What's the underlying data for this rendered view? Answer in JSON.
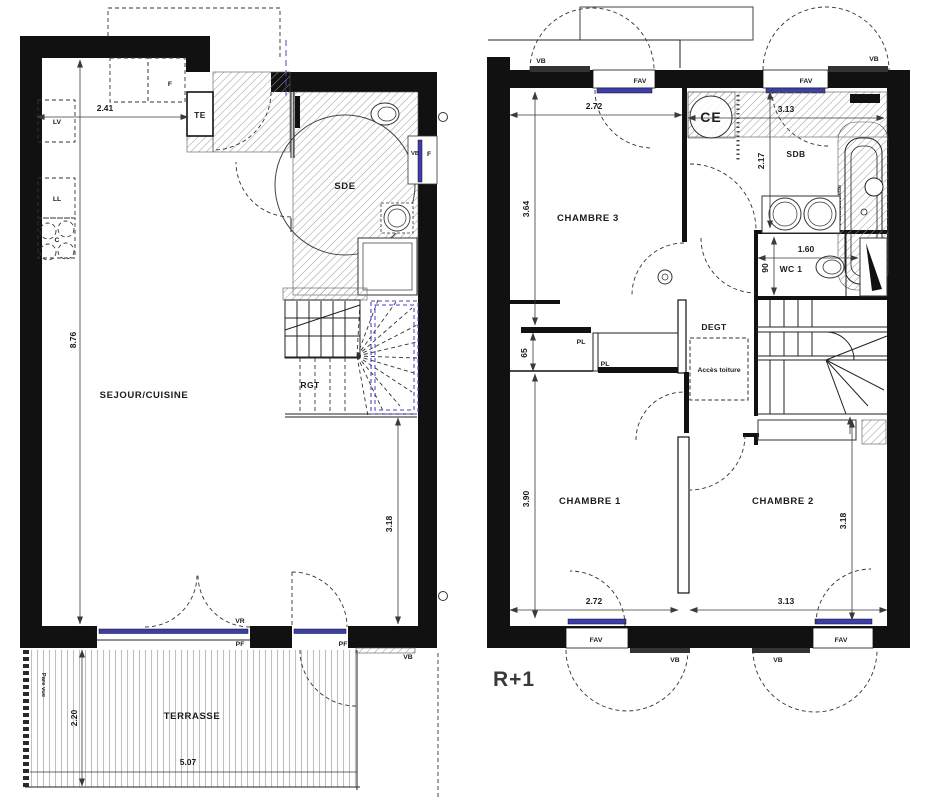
{
  "colors": {
    "wall": "#111111",
    "glazing": "#3d3dae",
    "stair_outline": "#4343c0"
  },
  "ground": {
    "rooms": {
      "sejour": "SEJOUR/CUISINE",
      "sde": "SDE",
      "rgt": "RGT",
      "te": "TE",
      "terrasse": "TERRASSE"
    },
    "appliances": {
      "lv": "LV",
      "ll": "LL",
      "hob": "C",
      "fridge": "F",
      "f_window": "F",
      "vb_window": "VB"
    },
    "dims": {
      "top_width": "2.41",
      "left_height": "8.76",
      "right_height": "3.18",
      "terrasse_height": "2.20",
      "terrasse_width": "5.07"
    },
    "openings": {
      "vr": "VR",
      "pf": "PF",
      "vb_door": "VB"
    },
    "annotations": {
      "pare_vue": "Pare vue"
    }
  },
  "first": {
    "floor_label": "R+1",
    "rooms": {
      "chambre1": "CHAMBRE 1",
      "chambre2": "CHAMBRE 2",
      "chambre3": "CHAMBRE 3",
      "sdb": "SDB",
      "wc": "WC 1",
      "degt": "DEGT",
      "ce": "CE"
    },
    "closets": {
      "pl": "PL"
    },
    "annotations": {
      "acces_toiture": "Accès toiture",
      "porte_serviette": "Porte serviette"
    },
    "dims": {
      "ch3_width": "2.72",
      "ch3_height": "3.64",
      "sdb_width": "3.13",
      "sdb_height": "2.17",
      "wc_width": "1.60",
      "wc_depth": "90",
      "niche_depth": "65",
      "ch1_width": "2.72",
      "ch1_height": "3.90",
      "ch2_width": "3.13",
      "ch2_height": "3.18"
    },
    "openings": {
      "fav": "FAV",
      "vb": "VB"
    }
  }
}
